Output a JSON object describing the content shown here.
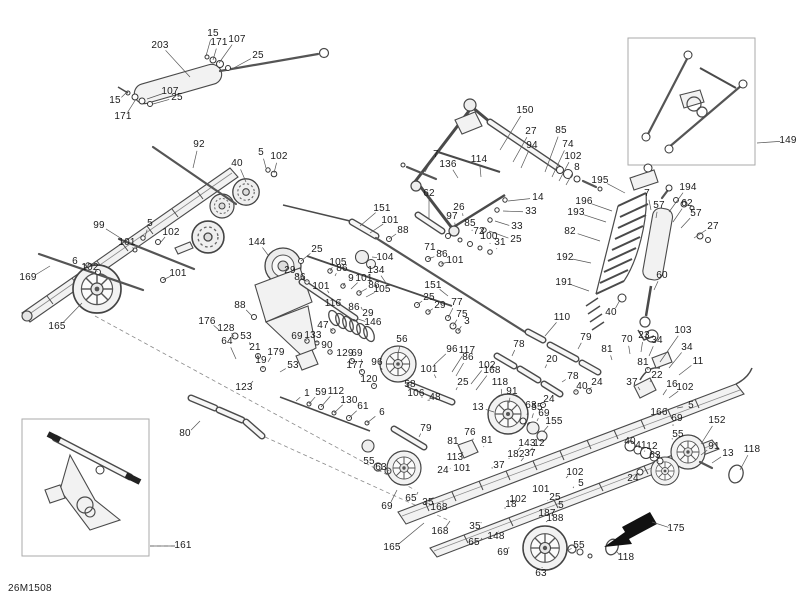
{
  "meta": {
    "page_code": "26M1508",
    "description": "Exploded parts diagram - rear suspension"
  },
  "insets": [
    {
      "name": "assembled-rear-arm-inset",
      "label": "149"
    },
    {
      "name": "assembled-front-arm-inset",
      "label": "161"
    }
  ],
  "callouts": [
    {
      "t": "203",
      "x": 160,
      "y": 46,
      "lx": 190,
      "ly": 77
    },
    {
      "t": "15",
      "x": 213,
      "y": 34,
      "lx": 206,
      "ly": 56
    },
    {
      "t": "171",
      "x": 219,
      "y": 43,
      "lx": 213,
      "ly": 60
    },
    {
      "t": "107",
      "x": 237,
      "y": 40,
      "lx": 219,
      "ly": 63
    },
    {
      "t": "25",
      "x": 258,
      "y": 56,
      "lx": 230,
      "ly": 70
    },
    {
      "t": "15",
      "x": 115,
      "y": 101,
      "lx": 127,
      "ly": 92
    },
    {
      "t": "171",
      "x": 123,
      "y": 117,
      "lx": 136,
      "ly": 99
    },
    {
      "t": "107",
      "x": 170,
      "y": 92,
      "lx": 147,
      "ly": 99
    },
    {
      "t": "25",
      "x": 177,
      "y": 98,
      "lx": 153,
      "ly": 104
    },
    {
      "t": "150",
      "x": 525,
      "y": 111,
      "lx": 500,
      "ly": 150
    },
    {
      "t": "27",
      "x": 531,
      "y": 132,
      "lx": 513,
      "ly": 162
    },
    {
      "t": "94",
      "x": 532,
      "y": 146,
      "lx": 521,
      "ly": 168
    },
    {
      "t": "85",
      "x": 561,
      "y": 131,
      "lx": 545,
      "ly": 172
    },
    {
      "t": "74",
      "x": 568,
      "y": 145,
      "lx": 552,
      "ly": 177
    },
    {
      "t": "102",
      "x": 573,
      "y": 157,
      "lx": 559,
      "ly": 181
    },
    {
      "t": "8",
      "x": 577,
      "y": 168,
      "lx": 566,
      "ly": 185
    },
    {
      "t": "7",
      "x": 436,
      "y": 155,
      "lx": 425,
      "ly": 172
    },
    {
      "t": "136",
      "x": 448,
      "y": 165,
      "lx": 458,
      "ly": 178
    },
    {
      "t": "114",
      "x": 479,
      "y": 160,
      "lx": 481,
      "ly": 177
    },
    {
      "t": "62",
      "x": 429,
      "y": 194,
      "lx": 429,
      "ly": 219
    },
    {
      "t": "26",
      "x": 459,
      "y": 208,
      "lx": 463,
      "ly": 216
    },
    {
      "t": "97",
      "x": 452,
      "y": 217,
      "lx": 455,
      "ly": 225
    },
    {
      "t": "85",
      "x": 470,
      "y": 224,
      "lx": 472,
      "ly": 231
    },
    {
      "t": "72",
      "x": 479,
      "y": 232,
      "lx": 481,
      "ly": 239
    },
    {
      "t": "100",
      "x": 489,
      "y": 237,
      "lx": 490,
      "ly": 244
    },
    {
      "t": "31",
      "x": 500,
      "y": 243,
      "lx": 497,
      "ly": 249
    },
    {
      "t": "71",
      "x": 430,
      "y": 248,
      "lx": 443,
      "ly": 252
    },
    {
      "t": "14",
      "x": 538,
      "y": 198,
      "lx": 508,
      "ly": 201
    },
    {
      "t": "33",
      "x": 531,
      "y": 212,
      "lx": 503,
      "ly": 211
    },
    {
      "t": "33",
      "x": 517,
      "y": 227,
      "lx": 495,
      "ly": 221
    },
    {
      "t": "25",
      "x": 516,
      "y": 240,
      "lx": 489,
      "ly": 231
    },
    {
      "t": "149",
      "x": 788,
      "y": 141,
      "lx": 757,
      "ly": 143
    },
    {
      "t": "151",
      "x": 382,
      "y": 209,
      "lx": 360,
      "ly": 226
    },
    {
      "t": "101",
      "x": 390,
      "y": 221,
      "lx": 370,
      "ly": 233
    },
    {
      "t": "88",
      "x": 403,
      "y": 231,
      "lx": 389,
      "ly": 239
    },
    {
      "t": "104",
      "x": 385,
      "y": 258,
      "lx": 372,
      "ly": 257
    },
    {
      "t": "86",
      "x": 442,
      "y": 255,
      "lx": 428,
      "ly": 259
    },
    {
      "t": "101",
      "x": 455,
      "y": 261,
      "lx": 441,
      "ly": 264
    },
    {
      "t": "25",
      "x": 317,
      "y": 250,
      "lx": 301,
      "ly": 261
    },
    {
      "t": "29",
      "x": 290,
      "y": 271,
      "lx": 299,
      "ly": 276
    },
    {
      "t": "86",
      "x": 300,
      "y": 278,
      "lx": 307,
      "ly": 282
    },
    {
      "t": "105",
      "x": 338,
      "y": 263,
      "lx": 330,
      "ly": 271
    },
    {
      "t": "86",
      "x": 342,
      "y": 269,
      "lx": 335,
      "ly": 276
    },
    {
      "t": "9",
      "x": 351,
      "y": 279,
      "lx": 343,
      "ly": 286
    },
    {
      "t": "101",
      "x": 364,
      "y": 279,
      "lx": 351,
      "ly": 289
    },
    {
      "t": "86",
      "x": 374,
      "y": 286,
      "lx": 359,
      "ly": 293
    },
    {
      "t": "105",
      "x": 382,
      "y": 290,
      "lx": 366,
      "ly": 297
    },
    {
      "t": "134",
      "x": 376,
      "y": 271,
      "lx": 388,
      "ly": 286
    },
    {
      "t": "101",
      "x": 321,
      "y": 287,
      "lx": 329,
      "ly": 293
    },
    {
      "t": "116",
      "x": 333,
      "y": 304,
      "lx": 341,
      "ly": 299
    },
    {
      "t": "86",
      "x": 354,
      "y": 308,
      "lx": 352,
      "ly": 302
    },
    {
      "t": "29",
      "x": 368,
      "y": 314,
      "lx": 361,
      "ly": 307
    },
    {
      "t": "146",
      "x": 373,
      "y": 323,
      "lx": 358,
      "ly": 319
    },
    {
      "t": "151",
      "x": 433,
      "y": 286,
      "lx": 448,
      "ly": 296
    },
    {
      "t": "25",
      "x": 429,
      "y": 298,
      "lx": 417,
      "ly": 305
    },
    {
      "t": "29",
      "x": 440,
      "y": 306,
      "lx": 428,
      "ly": 312
    },
    {
      "t": "77",
      "x": 457,
      "y": 303,
      "lx": 448,
      "ly": 318
    },
    {
      "t": "75",
      "x": 462,
      "y": 315,
      "lx": 453,
      "ly": 326
    },
    {
      "t": "3",
      "x": 467,
      "y": 322,
      "lx": 458,
      "ly": 331
    },
    {
      "t": "47",
      "x": 323,
      "y": 326,
      "lx": 333,
      "ly": 331
    },
    {
      "t": "69",
      "x": 297,
      "y": 337,
      "lx": 307,
      "ly": 341
    },
    {
      "t": "133",
      "x": 313,
      "y": 336,
      "lx": 317,
      "ly": 343
    },
    {
      "t": "90",
      "x": 327,
      "y": 346,
      "lx": 330,
      "ly": 352
    },
    {
      "t": "88",
      "x": 240,
      "y": 306,
      "lx": 252,
      "ly": 316
    },
    {
      "t": "176",
      "x": 207,
      "y": 322,
      "lx": 219,
      "ly": 330
    },
    {
      "t": "128",
      "x": 226,
      "y": 329,
      "lx": 234,
      "ly": 337
    },
    {
      "t": "53",
      "x": 246,
      "y": 337,
      "lx": 250,
      "ly": 345
    },
    {
      "t": "64",
      "x": 227,
      "y": 342,
      "lx": 236,
      "ly": 359
    },
    {
      "t": "21",
      "x": 255,
      "y": 348,
      "lx": 258,
      "ly": 356
    },
    {
      "t": "179",
      "x": 276,
      "y": 353,
      "lx": 268,
      "ly": 362
    },
    {
      "t": "19",
      "x": 261,
      "y": 361,
      "lx": 263,
      "ly": 369
    },
    {
      "t": "53",
      "x": 293,
      "y": 366,
      "lx": 280,
      "ly": 372
    },
    {
      "t": "123",
      "x": 244,
      "y": 388,
      "lx": 253,
      "ly": 381
    },
    {
      "t": "1",
      "x": 307,
      "y": 394,
      "lx": 296,
      "ly": 401
    },
    {
      "t": "59",
      "x": 321,
      "y": 393,
      "lx": 309,
      "ly": 404
    },
    {
      "t": "112",
      "x": 336,
      "y": 392,
      "lx": 321,
      "ly": 407
    },
    {
      "t": "130",
      "x": 349,
      "y": 401,
      "lx": 334,
      "ly": 413
    },
    {
      "t": "61",
      "x": 363,
      "y": 407,
      "lx": 349,
      "ly": 418
    },
    {
      "t": "6",
      "x": 382,
      "y": 413,
      "lx": 367,
      "ly": 423
    },
    {
      "t": "129",
      "x": 345,
      "y": 354,
      "lx": 352,
      "ly": 361
    },
    {
      "t": "69",
      "x": 357,
      "y": 354,
      "lx": 362,
      "ly": 362
    },
    {
      "t": "177",
      "x": 355,
      "y": 366,
      "lx": 362,
      "ly": 372
    },
    {
      "t": "120",
      "x": 369,
      "y": 380,
      "lx": 374,
      "ly": 386
    },
    {
      "t": "96",
      "x": 377,
      "y": 363,
      "lx": 382,
      "ly": 370
    },
    {
      "t": "56",
      "x": 402,
      "y": 340,
      "lx": 398,
      "ly": 354
    },
    {
      "t": "96",
      "x": 452,
      "y": 350,
      "lx": 434,
      "ly": 365
    },
    {
      "t": "117",
      "x": 467,
      "y": 351,
      "lx": 452,
      "ly": 372
    },
    {
      "t": "86",
      "x": 468,
      "y": 358,
      "lx": 456,
      "ly": 376
    },
    {
      "t": "101",
      "x": 429,
      "y": 370,
      "lx": 436,
      "ly": 378
    },
    {
      "t": "102",
      "x": 487,
      "y": 366,
      "lx": 471,
      "ly": 384
    },
    {
      "t": "168",
      "x": 492,
      "y": 371,
      "lx": 476,
      "ly": 390
    },
    {
      "t": "58",
      "x": 410,
      "y": 385,
      "lx": 416,
      "ly": 390
    },
    {
      "t": "106",
      "x": 416,
      "y": 394,
      "lx": 421,
      "ly": 397
    },
    {
      "t": "48",
      "x": 435,
      "y": 398,
      "lx": 430,
      "ly": 400
    },
    {
      "t": "25",
      "x": 463,
      "y": 383,
      "lx": 456,
      "ly": 390
    },
    {
      "t": "92",
      "x": 199,
      "y": 145,
      "lx": 193,
      "ly": 168
    },
    {
      "t": "40",
      "x": 237,
      "y": 164,
      "lx": 246,
      "ly": 182
    },
    {
      "t": "5",
      "x": 261,
      "y": 153,
      "lx": 266,
      "ly": 168
    },
    {
      "t": "102",
      "x": 279,
      "y": 157,
      "lx": 274,
      "ly": 173
    },
    {
      "t": "99",
      "x": 99,
      "y": 226,
      "lx": 122,
      "ly": 239
    },
    {
      "t": "5",
      "x": 150,
      "y": 224,
      "lx": 145,
      "ly": 237
    },
    {
      "t": "102",
      "x": 171,
      "y": 233,
      "lx": 161,
      "ly": 242
    },
    {
      "t": "101",
      "x": 127,
      "y": 243,
      "lx": 134,
      "ly": 250
    },
    {
      "t": "6",
      "x": 75,
      "y": 262,
      "lx": 87,
      "ly": 266
    },
    {
      "t": "102",
      "x": 90,
      "y": 268,
      "lx": 97,
      "ly": 272
    },
    {
      "t": "169",
      "x": 28,
      "y": 278,
      "lx": 50,
      "ly": 266
    },
    {
      "t": "101",
      "x": 178,
      "y": 274,
      "lx": 163,
      "ly": 280
    },
    {
      "t": "165",
      "x": 57,
      "y": 327,
      "lx": 82,
      "ly": 303
    },
    {
      "t": "144",
      "x": 257,
      "y": 243,
      "lx": 268,
      "ly": 255
    },
    {
      "t": "195",
      "x": 600,
      "y": 181,
      "lx": 625,
      "ly": 193
    },
    {
      "t": "196",
      "x": 584,
      "y": 202,
      "lx": 612,
      "ly": 211
    },
    {
      "t": "193",
      "x": 576,
      "y": 213,
      "lx": 606,
      "ly": 222
    },
    {
      "t": "82",
      "x": 570,
      "y": 232,
      "lx": 600,
      "ly": 241
    },
    {
      "t": "192",
      "x": 565,
      "y": 258,
      "lx": 591,
      "ly": 263
    },
    {
      "t": "191",
      "x": 564,
      "y": 283,
      "lx": 589,
      "ly": 291
    },
    {
      "t": "194",
      "x": 688,
      "y": 188,
      "lx": 669,
      "ly": 212
    },
    {
      "t": "7",
      "x": 647,
      "y": 194,
      "lx": 651,
      "ly": 210
    },
    {
      "t": "57",
      "x": 659,
      "y": 206,
      "lx": 656,
      "ly": 218
    },
    {
      "t": "62",
      "x": 687,
      "y": 204,
      "lx": 673,
      "ly": 222
    },
    {
      "t": "57",
      "x": 696,
      "y": 214,
      "lx": 681,
      "ly": 228
    },
    {
      "t": "27",
      "x": 713,
      "y": 227,
      "lx": 694,
      "ly": 238
    },
    {
      "t": "60",
      "x": 662,
      "y": 276,
      "lx": 654,
      "ly": 290
    },
    {
      "t": "40",
      "x": 611,
      "y": 313,
      "lx": 620,
      "ly": 300
    },
    {
      "t": "110",
      "x": 562,
      "y": 318,
      "lx": 545,
      "ly": 336
    },
    {
      "t": "78",
      "x": 519,
      "y": 345,
      "lx": 512,
      "ly": 356
    },
    {
      "t": "20",
      "x": 552,
      "y": 360,
      "lx": 545,
      "ly": 368
    },
    {
      "t": "78",
      "x": 573,
      "y": 377,
      "lx": 562,
      "ly": 382
    },
    {
      "t": "40",
      "x": 582,
      "y": 387,
      "lx": 576,
      "ly": 392
    },
    {
      "t": "24",
      "x": 597,
      "y": 383,
      "lx": 589,
      "ly": 391
    },
    {
      "t": "24",
      "x": 549,
      "y": 400,
      "lx": 543,
      "ly": 405
    },
    {
      "t": "79",
      "x": 586,
      "y": 338,
      "lx": 578,
      "ly": 349
    },
    {
      "t": "81",
      "x": 607,
      "y": 350,
      "lx": 612,
      "ly": 360
    },
    {
      "t": "70",
      "x": 627,
      "y": 340,
      "lx": 630,
      "ly": 354
    },
    {
      "t": "23",
      "x": 644,
      "y": 336,
      "lx": 641,
      "ly": 352
    },
    {
      "t": "34",
      "x": 657,
      "y": 341,
      "lx": 649,
      "ly": 356
    },
    {
      "t": "103",
      "x": 683,
      "y": 331,
      "lx": 660,
      "ly": 362
    },
    {
      "t": "34",
      "x": 687,
      "y": 348,
      "lx": 669,
      "ly": 368
    },
    {
      "t": "11",
      "x": 698,
      "y": 362,
      "lx": 679,
      "ly": 375
    },
    {
      "t": "81",
      "x": 643,
      "y": 363,
      "lx": 648,
      "ly": 370
    },
    {
      "t": "22",
      "x": 657,
      "y": 376,
      "lx": 650,
      "ly": 382
    },
    {
      "t": "37",
      "x": 632,
      "y": 383,
      "lx": 640,
      "ly": 390
    },
    {
      "t": "16",
      "x": 672,
      "y": 385,
      "lx": 663,
      "ly": 395
    },
    {
      "t": "102",
      "x": 685,
      "y": 388,
      "lx": 669,
      "ly": 398
    },
    {
      "t": "5",
      "x": 691,
      "y": 406,
      "lx": 677,
      "ly": 408
    },
    {
      "t": "166",
      "x": 659,
      "y": 413,
      "lx": 667,
      "ly": 408
    },
    {
      "t": "69",
      "x": 677,
      "y": 419,
      "lx": 673,
      "ly": 426
    },
    {
      "t": "55",
      "x": 678,
      "y": 435,
      "lx": 673,
      "ly": 439
    },
    {
      "t": "152",
      "x": 717,
      "y": 421,
      "lx": 701,
      "ly": 444
    },
    {
      "t": "91",
      "x": 714,
      "y": 447,
      "lx": 701,
      "ly": 455
    },
    {
      "t": "13",
      "x": 728,
      "y": 454,
      "lx": 712,
      "ly": 463
    },
    {
      "t": "118",
      "x": 752,
      "y": 450,
      "lx": 740,
      "ly": 470
    },
    {
      "t": "40",
      "x": 630,
      "y": 442,
      "lx": 634,
      "ly": 448
    },
    {
      "t": "41",
      "x": 641,
      "y": 446,
      "lx": 644,
      "ly": 451
    },
    {
      "t": "12",
      "x": 652,
      "y": 447,
      "lx": 654,
      "ly": 453
    },
    {
      "t": "63",
      "x": 655,
      "y": 456,
      "lx": 657,
      "ly": 460
    },
    {
      "t": "24",
      "x": 633,
      "y": 479,
      "lx": 639,
      "ly": 473
    },
    {
      "t": "175",
      "x": 676,
      "y": 529,
      "lx": 652,
      "ly": 522
    },
    {
      "t": "118",
      "x": 626,
      "y": 558,
      "lx": 616,
      "ly": 551
    },
    {
      "t": "155",
      "x": 554,
      "y": 422,
      "lx": 543,
      "ly": 432
    },
    {
      "t": "63",
      "x": 531,
      "y": 406,
      "lx": 527,
      "ly": 415
    },
    {
      "t": "55",
      "x": 537,
      "y": 408,
      "lx": 532,
      "ly": 418
    },
    {
      "t": "69",
      "x": 544,
      "y": 414,
      "lx": 537,
      "ly": 421
    },
    {
      "t": "91",
      "x": 512,
      "y": 392,
      "lx": 509,
      "ly": 403
    },
    {
      "t": "118",
      "x": 500,
      "y": 383,
      "lx": 502,
      "ly": 396
    },
    {
      "t": "13",
      "x": 478,
      "y": 408,
      "lx": 494,
      "ly": 412
    },
    {
      "t": "113",
      "x": 455,
      "y": 458,
      "lx": 463,
      "ly": 452
    },
    {
      "t": "81",
      "x": 453,
      "y": 442,
      "lx": 459,
      "ly": 447
    },
    {
      "t": "76",
      "x": 470,
      "y": 433,
      "lx": 473,
      "ly": 440
    },
    {
      "t": "81",
      "x": 487,
      "y": 441,
      "lx": 484,
      "ly": 447
    },
    {
      "t": "143",
      "x": 527,
      "y": 444,
      "lx": 518,
      "ly": 450
    },
    {
      "t": "12",
      "x": 539,
      "y": 444,
      "lx": 529,
      "ly": 452
    },
    {
      "t": "182",
      "x": 516,
      "y": 455,
      "lx": 509,
      "ly": 459
    },
    {
      "t": "37",
      "x": 530,
      "y": 454,
      "lx": 521,
      "ly": 461
    },
    {
      "t": "37",
      "x": 499,
      "y": 466,
      "lx": 493,
      "ly": 468
    },
    {
      "t": "101",
      "x": 462,
      "y": 469,
      "lx": 468,
      "ly": 466
    },
    {
      "t": "24",
      "x": 443,
      "y": 471,
      "lx": 450,
      "ly": 468
    },
    {
      "t": "102",
      "x": 575,
      "y": 473,
      "lx": 566,
      "ly": 478
    },
    {
      "t": "101",
      "x": 541,
      "y": 490,
      "lx": 533,
      "ly": 492
    },
    {
      "t": "102",
      "x": 518,
      "y": 500,
      "lx": 512,
      "ly": 501
    },
    {
      "t": "5",
      "x": 581,
      "y": 484,
      "lx": 573,
      "ly": 488
    },
    {
      "t": "25",
      "x": 555,
      "y": 498,
      "lx": 548,
      "ly": 501
    },
    {
      "t": "5",
      "x": 561,
      "y": 506,
      "lx": 553,
      "ly": 507
    },
    {
      "t": "18",
      "x": 511,
      "y": 505,
      "lx": 506,
      "ly": 508
    },
    {
      "t": "187",
      "x": 547,
      "y": 514,
      "lx": 539,
      "ly": 517
    },
    {
      "t": "188",
      "x": 555,
      "y": 519,
      "lx": 546,
      "ly": 522
    },
    {
      "t": "35",
      "x": 475,
      "y": 527,
      "lx": 481,
      "ly": 522
    },
    {
      "t": "148",
      "x": 496,
      "y": 537,
      "lx": 498,
      "ly": 531
    },
    {
      "t": "65",
      "x": 474,
      "y": 543,
      "lx": 482,
      "ly": 538
    },
    {
      "t": "69",
      "x": 503,
      "y": 553,
      "lx": 509,
      "ly": 547
    },
    {
      "t": "63",
      "x": 541,
      "y": 574,
      "lx": 542,
      "ly": 567
    },
    {
      "t": "55",
      "x": 579,
      "y": 546,
      "lx": 569,
      "ly": 550
    },
    {
      "t": "79",
      "x": 426,
      "y": 429,
      "lx": 419,
      "ly": 437
    },
    {
      "t": "55",
      "x": 369,
      "y": 462,
      "lx": 377,
      "ly": 466
    },
    {
      "t": "63",
      "x": 381,
      "y": 468,
      "lx": 389,
      "ly": 471
    },
    {
      "t": "69",
      "x": 387,
      "y": 507,
      "lx": 397,
      "ly": 490
    },
    {
      "t": "65",
      "x": 411,
      "y": 499,
      "lx": 418,
      "ly": 492
    },
    {
      "t": "35",
      "x": 428,
      "y": 503,
      "lx": 433,
      "ly": 497
    },
    {
      "t": "168",
      "x": 439,
      "y": 508,
      "lx": 443,
      "ly": 501
    },
    {
      "t": "168",
      "x": 440,
      "y": 532,
      "lx": 450,
      "ly": 521
    },
    {
      "t": "165",
      "x": 392,
      "y": 548,
      "lx": 424,
      "ly": 523
    },
    {
      "t": "80",
      "x": 185,
      "y": 434,
      "lx": 200,
      "ly": 421
    },
    {
      "t": "161",
      "x": 183,
      "y": 546,
      "lx": 150,
      "ly": 546
    }
  ]
}
